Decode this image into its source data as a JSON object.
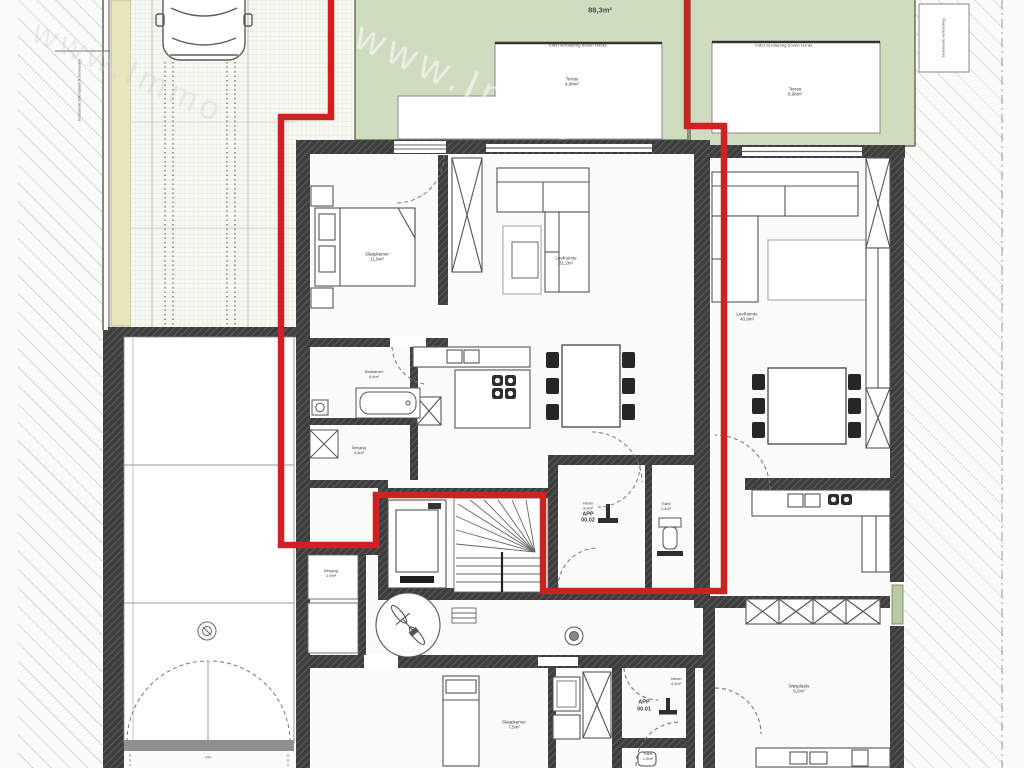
{
  "watermark": {
    "text": "www.Immo"
  },
  "colors": {
    "garden_green": "#cfdcc0",
    "boundary_red": "#ce2222",
    "wall_dark": "#3d3d3d",
    "strip_yellow": "#e9e6bd"
  },
  "site": {
    "left_note": "bestaande betonplaat te behouden",
    "right_note": "bestaande verharding",
    "garage_door_dim": "240"
  },
  "garden_left": {
    "clipped_label": "Tuin",
    "area": "88,3m²"
  },
  "garden_right": {
    "clipped_label": "Tuin"
  },
  "terrace_left": {
    "caption": "luifel verdieping boven terras",
    "label": "Terras",
    "area": "9,08m²"
  },
  "terrace_right": {
    "caption": "luifel verdieping boven terras",
    "label": "Terras",
    "area": "8,08m²"
  },
  "app_00_02": {
    "bedroom": {
      "label": "Slaapkamer",
      "area": "11,8m²"
    },
    "living": {
      "label": "Leefruimte",
      "area": "31,2m²"
    },
    "bathroom": {
      "label": "Badkamer",
      "area": "4,4m²"
    },
    "storage": {
      "label": "Berging",
      "area": "4,8m²"
    },
    "hall": {
      "label": "Inkom",
      "area": "3,9m²",
      "unit": "APP",
      "number": "00.02"
    },
    "toilet": {
      "label": "Toilet",
      "area": "1,4m²"
    }
  },
  "app_00_01": {
    "bedroom": {
      "label": "Slaapkamer",
      "area": "7,5m²"
    },
    "hall": {
      "label": "Inkom",
      "area": "4,1m²",
      "unit": "APP",
      "number": "00.01"
    },
    "toilet": {
      "label": "Toilet",
      "area": "1,5m²"
    },
    "laundry": {
      "label": "Wasplaats",
      "area": "6,2m²"
    }
  },
  "app_right": {
    "living": {
      "label": "Leefruimte",
      "area": "40,9m²"
    }
  },
  "common": {
    "storage": {
      "label": "Berging",
      "area": "1,9m²"
    }
  }
}
